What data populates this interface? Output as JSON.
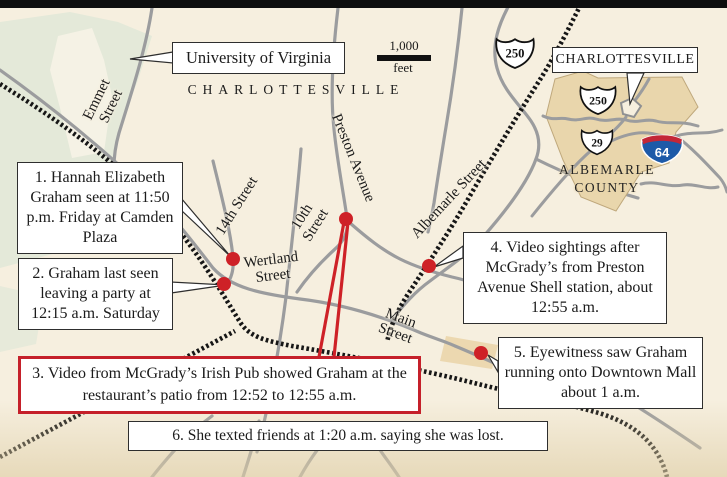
{
  "map": {
    "city_label": "CHARLOTTESVILLE",
    "uva_label": "University of Virginia",
    "scale": {
      "distance": "1,000",
      "unit": "feet"
    },
    "route_shields": {
      "us250_main": "250"
    },
    "streets": {
      "emmet": {
        "line1": "Emmet",
        "line2": "Street"
      },
      "fourteenth": {
        "line1": "14th Street"
      },
      "tenth": {
        "line1": "10th",
        "line2": "Street"
      },
      "preston": {
        "line1": "Preston Avenue"
      },
      "wertland": {
        "line1": "Wertland",
        "line2": "Street"
      },
      "albemarle": {
        "line1": "Albemarle Street"
      },
      "main": {
        "line1": "Main",
        "line2": "Street"
      }
    }
  },
  "callouts": {
    "c1": "1. Hannah Elizabeth Graham seen at 11:50 p.m. Friday at Camden Plaza",
    "c2": "2. Graham last seen leaving a party at 12:15 a.m. Saturday",
    "c3": "3. Video from McGrady’s Irish Pub showed Graham at the restaurant’s patio from 12:52 to 12:55 a.m.",
    "c4": "4. Video sightings after McGrady’s from Preston Avenue Shell station, about 12:55 a.m.",
    "c5": "5. Eyewitness saw Graham running  onto Downtown Mall about 1 a.m.",
    "c6": "6. She texted friends at 1:20 a.m.  saying she was lost."
  },
  "inset": {
    "city_label": "CHARLOTTESVILLE",
    "county_line1": "ALBEMARLE",
    "county_line2": "COUNTY",
    "route_shields": {
      "us250": "250",
      "us29": "29",
      "i64": "64"
    }
  },
  "colors": {
    "background": "#f6efdf",
    "campus_green": "#e4e9d9",
    "county_tan": "#e9d6ac",
    "mall_tan": "#ecd8b0",
    "road_gray": "#9b9c9e",
    "railroad_black": "#161616",
    "marker_red": "#ce2127",
    "highlight_border_red": "#c5202a",
    "interstate_blue": "#1d5aa8",
    "interstate_red": "#c32737"
  }
}
